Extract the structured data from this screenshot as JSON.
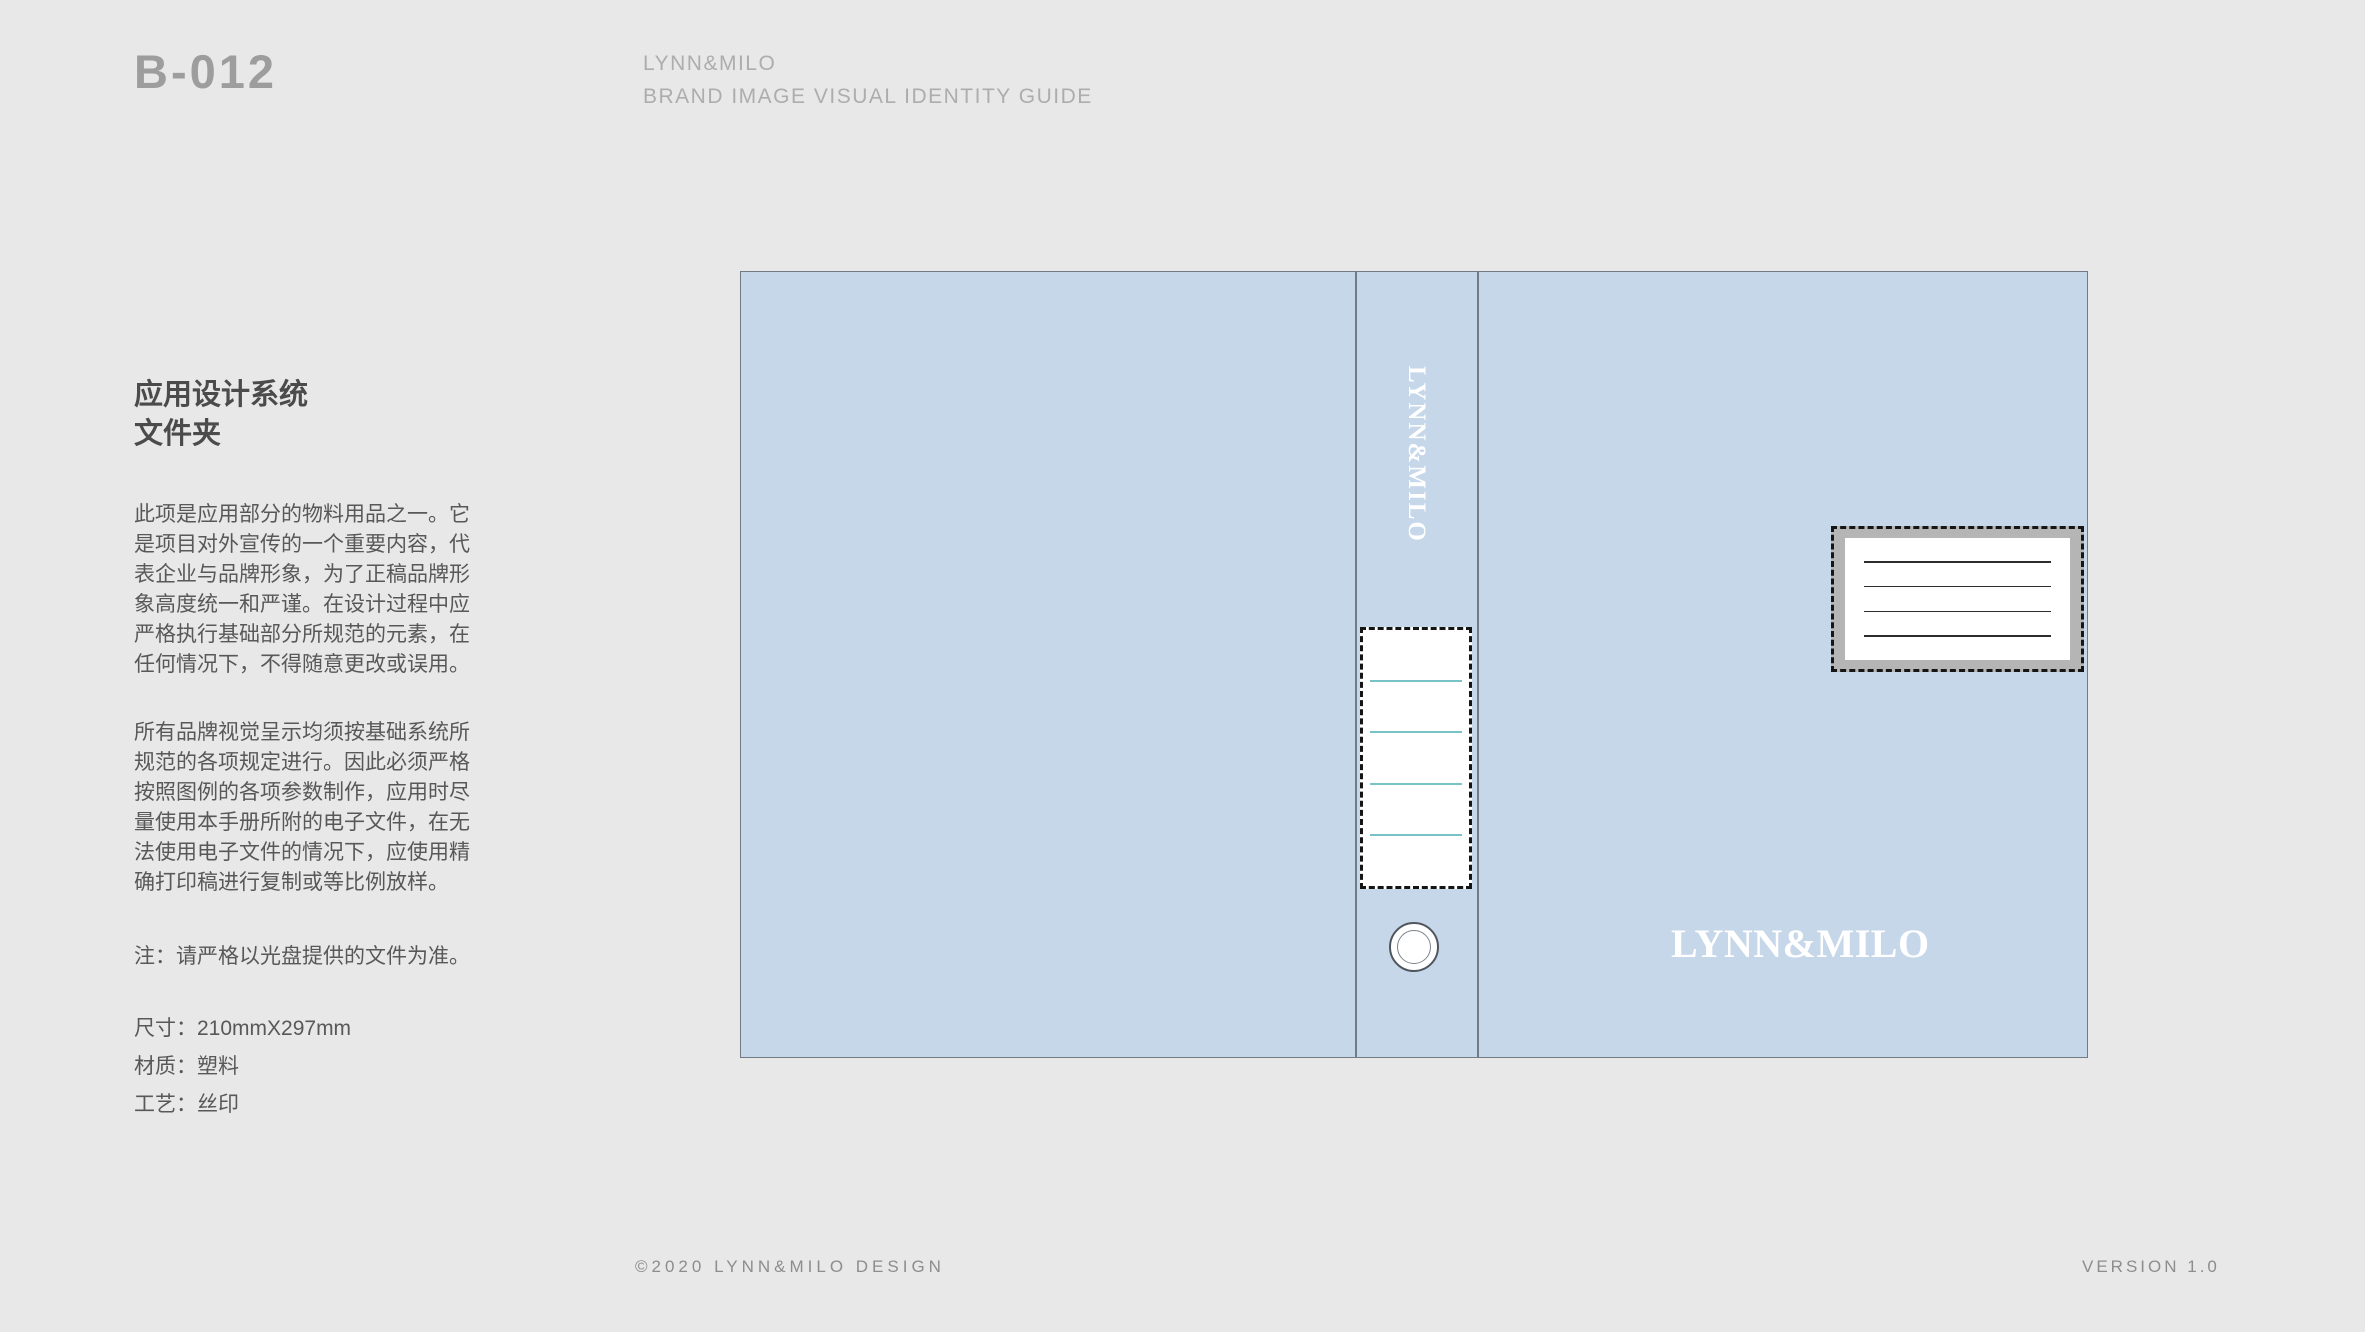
{
  "header": {
    "code": "B-012",
    "brand": "LYNN&MILO",
    "subtitle": "BRAND IMAGE VISUAL IDENTITY GUIDE"
  },
  "sidebar": {
    "title_line1": "应用设计系统",
    "title_line2": "文件夹",
    "paragraph1": "此项是应用部分的物料用品之一。它是项目对外宣传的一个重要内容，代表企业与品牌形象，为了正稿品牌形象高度统一和严谨。在设计过程中应严格执行基础部分所规范的元素，在任何情况下，不得随意更改或误用。",
    "paragraph2": "所有品牌视觉呈示均须按基础系统所规范的各项规定进行。因此必须严格按照图例的各项参数制作，应用时尽量使用本手册所附的电子文件，在无法使用电子文件的情况下，应使用精确打印稿进行复制或等比例放样。",
    "note": "注：请严格以光盘提供的文件为准。",
    "specs": [
      {
        "label": "尺寸：",
        "value": "210mmX297mm"
      },
      {
        "label": "材质：",
        "value": "塑料"
      },
      {
        "label": "工艺：",
        "value": "丝印"
      }
    ]
  },
  "mockup": {
    "spine_logo": "LYNN&MILO",
    "front_logo": "LYNN&MILO",
    "colors": {
      "folder_blue": "#c6d7ea",
      "outline_gray": "#727a86",
      "spine_label_line_teal": "#79c2c6",
      "front_label_frame_gray": "#b5b5b5",
      "dash_black": "#151515",
      "page_background": "#e8e8e8"
    }
  },
  "footer": {
    "copyright": "©2020 LYNN&MILO DESIGN",
    "version": "VERSION 1.0"
  }
}
